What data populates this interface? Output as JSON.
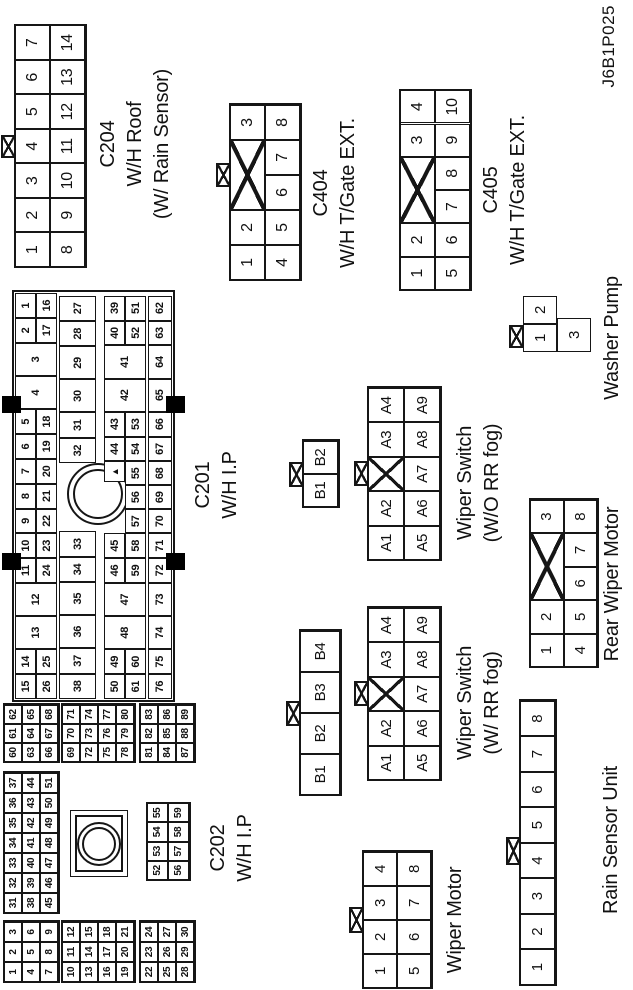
{
  "page_id": "J6B1P025",
  "colors": {
    "line": "#161616",
    "background": "#ffffff",
    "mount_tab_fill": "#000000"
  },
  "connectors": [
    {
      "id": "c204-wh-roof",
      "title": "C204",
      "subtitle": "W/H Roof (W/ Rain Sensor)",
      "labels": [
        {
          "x": 846,
          "y": 95,
          "fs": 20,
          "lh": 27,
          "lines": [
            "C204",
            "W/H Roof",
            "(W/ Rain Sensor)"
          ]
        }
      ],
      "grids": [
        {
          "x": 723,
          "y": 15,
          "cw": 34.5,
          "ch": 35,
          "fs": 16,
          "frame": true,
          "rows": [
            [
              "1",
              "2",
              "3",
              "4",
              "5",
              "6",
              "7"
            ],
            [
              "8",
              "9",
              "10",
              "11",
              "12",
              "13",
              "14"
            ]
          ]
        }
      ],
      "tabs": [
        {
          "x": 832,
          "y": 1,
          "w": 23,
          "h": 15
        }
      ]
    },
    {
      "id": "c404-wh-tgate-ext",
      "title": "C404",
      "subtitle": "W/H T/Gate EXT.",
      "labels": [
        {
          "x": 797,
          "y": 308,
          "fs": 20,
          "lh": 27,
          "lines": [
            "C404",
            "W/H T/Gate EXT."
          ]
        }
      ],
      "grids": [
        {
          "x": 710,
          "y": 230,
          "cw": 35,
          "ch": 35,
          "fs": 16,
          "frame": true,
          "rows": [
            [
              "1",
              "2",
              {
                "cross": true,
                "w": 2
              },
              "3"
            ],
            [
              "4",
              "5",
              "6",
              "7",
              "8"
            ]
          ]
        }
      ],
      "tabs": [
        {
          "x": 803,
          "y": 216,
          "w": 24,
          "h": 15
        }
      ]
    },
    {
      "id": "c405-wh-tgate-ext",
      "title": "C405",
      "subtitle": "W/H T/Gate EXT.",
      "labels": [
        {
          "x": 800,
          "y": 478,
          "fs": 20,
          "lh": 27,
          "lines": [
            "C405",
            "W/H T/Gate EXT."
          ]
        }
      ],
      "grids": [
        {
          "x": 700,
          "y": 400,
          "cw": 33.3,
          "ch": 35,
          "fs": 16,
          "frame": true,
          "rows": [
            [
              "1",
              "2",
              {
                "cross": true,
                "w": 2
              },
              "3",
              "4"
            ],
            [
              "5",
              "6",
              "7",
              "8",
              "9",
              "10"
            ]
          ]
        }
      ]
    },
    {
      "id": "c201-wh-ip",
      "title": "C201",
      "subtitle": "W/H I.P",
      "labels": [
        {
          "x": 505,
          "y": 190,
          "fs": 20,
          "lh": 27,
          "lines": [
            "C201",
            "W/H I.P"
          ]
        }
      ],
      "decors": [
        {
          "type": "rect",
          "x": 288,
          "y": 12,
          "w": 412,
          "h": 163,
          "bw": 2
        },
        {
          "type": "ring",
          "cx": 496,
          "cy": 98,
          "r": 31,
          "bw": 2
        },
        {
          "type": "ring",
          "cx": 496,
          "cy": 98,
          "r": 25,
          "bw": 2
        },
        {
          "type": "black",
          "x": 420,
          "y": 2,
          "w": 17,
          "h": 19
        },
        {
          "type": "black",
          "x": 577,
          "y": 2,
          "w": 17,
          "h": 19
        },
        {
          "type": "black",
          "x": 420,
          "y": 166,
          "w": 17,
          "h": 19
        },
        {
          "type": "black",
          "x": 577,
          "y": 166,
          "w": 17,
          "h": 19
        }
      ],
      "grids": [
        {
          "x": 291,
          "y": 15,
          "cw": 24.8,
          "ch": 21,
          "fs": 11,
          "rows": [
            [
              "15",
              "14",
              {
                "t": "13",
                "w": 1.34,
                "h": 2
              },
              {
                "t": "12",
                "w": 1.34,
                "h": 2
              },
              "11",
              "10",
              "9",
              "8",
              "7",
              "6",
              "5",
              {
                "t": "4",
                "w": 1.34,
                "h": 2
              },
              {
                "t": "3",
                "w": 1.34,
                "h": 2
              },
              "2",
              "1"
            ],
            [
              "26",
              "25",
              {
                "skip": 1.34
              },
              {
                "skip": 1.34
              },
              "24",
              "23",
              "22",
              "21",
              "20",
              "19",
              "18",
              {
                "skip": 1.34
              },
              {
                "skip": 1.34
              },
              "17",
              "16"
            ]
          ]
        },
        {
          "x": 291,
          "y": 59,
          "cw": 25.4,
          "ch": 37,
          "fs": 11,
          "rows": [
            [
              "38",
              "37",
              {
                "t": "36",
                "w": 1.3
              },
              {
                "t": "35",
                "w": 1.3
              },
              "34",
              "33",
              {
                "skip": 2.68
              },
              "32",
              "31",
              {
                "t": "30",
                "w": 1.3
              },
              {
                "t": "29",
                "w": 1.3
              },
              "28",
              "27"
            ]
          ]
        },
        {
          "x": 291,
          "y": 104,
          "cw": 24.8,
          "ch": 21,
          "fs": 11,
          "rows": [
            [
              "50",
              "49",
              {
                "t": "48",
                "w": 1.34,
                "h": 2
              },
              {
                "t": "47",
                "w": 1.34,
                "h": 2
              },
              "46",
              "45",
              {
                "skip": 2.05
              },
              {
                "t": "",
                "marker": true,
                "w": 0.85
              },
              "44",
              "43",
              {
                "t": "42",
                "w": 1.34,
                "h": 2
              },
              {
                "t": "41",
                "w": 1.34,
                "h": 2
              },
              "40",
              "39"
            ],
            [
              "61",
              "60",
              {
                "skip": 1.34
              },
              {
                "skip": 1.34
              },
              "59",
              "58",
              {
                "t": "57",
                "w": 0.97
              },
              {
                "t": "56",
                "w": 0.97
              },
              {
                "t": "55",
                "w": 0.96
              },
              "54",
              "53",
              {
                "skip": 1.34
              },
              {
                "skip": 1.34
              },
              "52",
              "51"
            ]
          ]
        },
        {
          "x": 291,
          "y": 148,
          "cw": 24.8,
          "ch": 24,
          "fs": 11,
          "rows": [
            [
              "76",
              "75",
              {
                "t": "74",
                "w": 1.34
              },
              {
                "t": "73",
                "w": 1.34
              },
              "72",
              "71",
              {
                "t": "70",
                "w": 0.97
              },
              {
                "t": "69",
                "w": 0.97
              },
              {
                "t": "68",
                "w": 0.96
              },
              "67",
              "66",
              {
                "t": "65",
                "w": 1.34
              },
              {
                "t": "64",
                "w": 1.34
              },
              "63",
              "62"
            ]
          ]
        }
      ]
    },
    {
      "id": "c202-wh-ip",
      "title": "C202",
      "subtitle": "W/H I.P",
      "labels": [
        {
          "x": 142,
          "y": 205,
          "fs": 20,
          "lh": 27,
          "lines": [
            "C202",
            "W/H I.P"
          ]
        }
      ],
      "decors": [
        {
          "type": "rect",
          "x": 113,
          "y": 70,
          "w": 67,
          "h": 58,
          "bw": 1
        },
        {
          "type": "rect",
          "x": 118,
          "y": 75,
          "w": 57,
          "h": 48,
          "bw": 2
        },
        {
          "type": "ring",
          "cx": 146,
          "cy": 99,
          "r": 22,
          "bw": 2
        },
        {
          "type": "ring",
          "cx": 146,
          "cy": 99,
          "r": 17,
          "bw": 2
        }
      ],
      "grids": [
        {
          "x": 8,
          "y": 4,
          "cw": 20,
          "ch": 18,
          "fs": 10,
          "frame": true,
          "rows": [
            [
              "1",
              "2",
              "3"
            ],
            [
              "4",
              "5",
              "6"
            ],
            [
              "7",
              "8",
              "9"
            ]
          ]
        },
        {
          "x": 8,
          "y": 62,
          "cw": 20,
          "ch": 18,
          "fs": 10,
          "frame": true,
          "rows": [
            [
              "10",
              "11",
              "12"
            ],
            [
              "13",
              "14",
              "15"
            ],
            [
              "16",
              "17",
              "18"
            ],
            [
              "19",
              "20",
              "21"
            ]
          ]
        },
        {
          "x": 8,
          "y": 140,
          "cw": 20,
          "ch": 18,
          "fs": 10,
          "frame": true,
          "rows": [
            [
              "22",
              "23",
              "24"
            ],
            [
              "25",
              "26",
              "27"
            ],
            [
              "28",
              "29",
              "30"
            ]
          ]
        },
        {
          "x": 77,
          "y": 4,
          "cw": 20,
          "ch": 18,
          "fs": 10,
          "frame": true,
          "rows": [
            [
              "31",
              "32",
              "33",
              "34",
              "35",
              "36",
              "37"
            ],
            [
              "38",
              "39",
              "40",
              "41",
              "42",
              "43",
              "44"
            ],
            [
              "45",
              "46",
              "47",
              "48",
              "49",
              "50",
              "51"
            ]
          ]
        },
        {
          "x": 110,
          "y": 147,
          "cw": 19.2,
          "ch": 21,
          "fs": 10,
          "frame": true,
          "rows": [
            [
              "52",
              "53",
              "54",
              "55"
            ],
            [
              "56",
              "57",
              "58",
              "59"
            ]
          ]
        },
        {
          "x": 228,
          "y": 4,
          "cw": 19,
          "ch": 18,
          "fs": 10,
          "frame": true,
          "rows": [
            [
              "60",
              "61",
              "62"
            ],
            [
              "63",
              "64",
              "65"
            ],
            [
              "66",
              "67",
              "68"
            ]
          ]
        },
        {
          "x": 228,
          "y": 62,
          "cw": 19,
          "ch": 18,
          "fs": 10,
          "frame": true,
          "rows": [
            [
              "69",
              "70",
              "71"
            ],
            [
              "72",
              "73",
              "74"
            ],
            [
              "75",
              "76",
              "77"
            ],
            [
              "78",
              "79",
              "80"
            ]
          ]
        },
        {
          "x": 228,
          "y": 140,
          "cw": 19,
          "ch": 18,
          "fs": 10,
          "frame": true,
          "rows": [
            [
              "81",
              "82",
              "83"
            ],
            [
              "84",
              "85",
              "86"
            ],
            [
              "87",
              "88",
              "89"
            ]
          ]
        }
      ]
    },
    {
      "id": "wiper-switch-wo-rr-fog",
      "title": "Wiper Switch",
      "subtitle": "(W/O RR fog)",
      "labels": [
        {
          "x": 507,
          "y": 452,
          "fs": 20,
          "lh": 27,
          "lines": [
            "Wiper Switch",
            "(W/O RR fog)"
          ]
        }
      ],
      "grids": [
        {
          "x": 483,
          "y": 303,
          "cw": 33,
          "ch": 35,
          "fs": 15,
          "frame": true,
          "rows": [
            [
              "B1",
              "B2"
            ]
          ]
        },
        {
          "x": 430,
          "y": 368,
          "cw": 34.4,
          "ch": 36,
          "fs": 15,
          "frame": true,
          "rows": [
            [
              "A1",
              "A2",
              {
                "cross": true
              },
              "A3",
              "A4"
            ],
            [
              "A5",
              "A6",
              "A7",
              "A8",
              "A9"
            ]
          ]
        }
      ],
      "tabs": [
        {
          "x": 503,
          "y": 289,
          "w": 25,
          "h": 15
        },
        {
          "x": 504,
          "y": 354,
          "w": 25,
          "h": 15
        }
      ]
    },
    {
      "id": "wiper-switch-w-rr-fog",
      "title": "Wiper Switch",
      "subtitle": "(W/ RR fog)",
      "labels": [
        {
          "x": 287,
          "y": 452,
          "fs": 20,
          "lh": 27,
          "lines": [
            "Wiper Switch",
            "(W/ RR fog)"
          ]
        }
      ],
      "grids": [
        {
          "x": 195,
          "y": 300,
          "cw": 41,
          "ch": 40,
          "fs": 15,
          "frame": true,
          "rows": [
            [
              "B1",
              "B2",
              "B3",
              "B4"
            ]
          ]
        },
        {
          "x": 210,
          "y": 368,
          "cw": 34.4,
          "ch": 36,
          "fs": 15,
          "frame": true,
          "rows": [
            [
              "A1",
              "A2",
              {
                "cross": true
              },
              "A3",
              "A4"
            ],
            [
              "A5",
              "A6",
              "A7",
              "A8",
              "A9"
            ]
          ]
        }
      ],
      "tabs": [
        {
          "x": 264,
          "y": 286,
          "w": 25,
          "h": 15
        },
        {
          "x": 284,
          "y": 354,
          "w": 25,
          "h": 15
        }
      ]
    },
    {
      "id": "washer-pump",
      "title": "Washer Pump",
      "subtitle": "",
      "labels": [
        {
          "x": 652,
          "y": 599,
          "fs": 20,
          "lh": 27,
          "lines": [
            "Washer Pump"
          ]
        }
      ],
      "grids": [
        {
          "x": 638,
          "y": 523,
          "cw": 28,
          "ch": 34,
          "fs": 15,
          "rows": [
            [
              "1",
              "2"
            ]
          ]
        },
        {
          "x": 638,
          "y": 557,
          "cw": 34,
          "ch": 34,
          "fs": 15,
          "rows": [
            [
              "3"
            ]
          ]
        }
      ],
      "tabs": [
        {
          "x": 642,
          "y": 509,
          "w": 23,
          "h": 15
        }
      ]
    },
    {
      "id": "rear-wiper-motor",
      "title": "Rear Wiper Motor",
      "subtitle": "",
      "labels": [
        {
          "x": 406,
          "y": 599,
          "fs": 20,
          "lh": 27,
          "lines": [
            "Rear Wiper Motor"
          ]
        }
      ],
      "grids": [
        {
          "x": 323,
          "y": 530,
          "cw": 33.4,
          "ch": 33.5,
          "fs": 15,
          "frame": true,
          "rows": [
            [
              "1",
              "2",
              {
                "cross": true,
                "w": 2
              },
              "3"
            ],
            [
              "4",
              "5",
              "6",
              "7",
              "8"
            ]
          ]
        }
      ]
    },
    {
      "id": "wiper-motor",
      "title": "Wiper Motor",
      "subtitle": "",
      "labels": [
        {
          "x": 70,
          "y": 442,
          "fs": 20,
          "lh": 27,
          "lines": [
            "Wiper Motor"
          ]
        }
      ],
      "grids": [
        {
          "x": 2,
          "y": 363,
          "cw": 34,
          "ch": 34,
          "fs": 15,
          "frame": true,
          "rows": [
            [
              "1",
              "2",
              "3",
              "4"
            ],
            [
              "5",
              "6",
              "7",
              "8"
            ]
          ]
        }
      ],
      "tabs": [
        {
          "x": 57,
          "y": 349,
          "w": 26,
          "h": 15
        }
      ]
    },
    {
      "id": "rain-sensor-unit",
      "title": "Rain Sensor Unit",
      "subtitle": "",
      "labels": [
        {
          "x": 150,
          "y": 598,
          "fs": 20,
          "lh": 27,
          "lines": [
            "Rain Sensor Unit"
          ]
        }
      ],
      "grids": [
        {
          "x": 5,
          "y": 520,
          "cw": 35.5,
          "ch": 35,
          "fs": 15,
          "frame": true,
          "rows": [
            [
              "1",
              "2",
              "3",
              "4",
              "5",
              "6",
              "7",
              "8"
            ]
          ]
        }
      ],
      "tabs": [
        {
          "x": 125,
          "y": 506,
          "w": 28,
          "h": 15
        }
      ]
    }
  ]
}
